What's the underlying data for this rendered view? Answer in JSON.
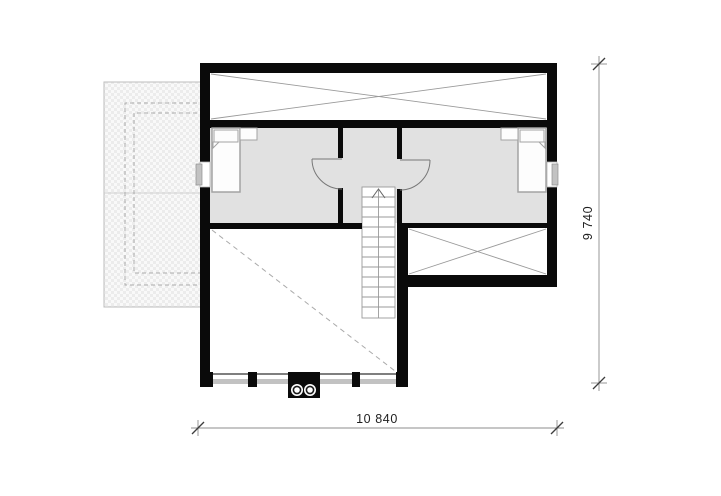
{
  "plan": {
    "dimension_bottom_label": "10 840",
    "dimension_right_label": "9 740"
  },
  "colors": {
    "wall": "#0a0a0a",
    "room-fill": "#e1e1e1",
    "detail-line": "#9a9a9a",
    "furniture-line": "#a3a3a3",
    "sill": "#c2c2c2",
    "dim-line": "#8c8c8c",
    "dim-tick": "#3d3d3d",
    "dim-text": "#1f1f1f",
    "hatch-base": "#f9f9f9",
    "hatch-cell": "#ececec",
    "hatch-border": "#bdbdbd",
    "dash-line": "#aaaaaa",
    "paper": "#ffffff"
  },
  "icons": {
    "bed_left": "bed-icon",
    "bed_right": "bed-icon",
    "stair_arrow": "arrow-up-icon",
    "flues": "chimney-flue-icon"
  }
}
